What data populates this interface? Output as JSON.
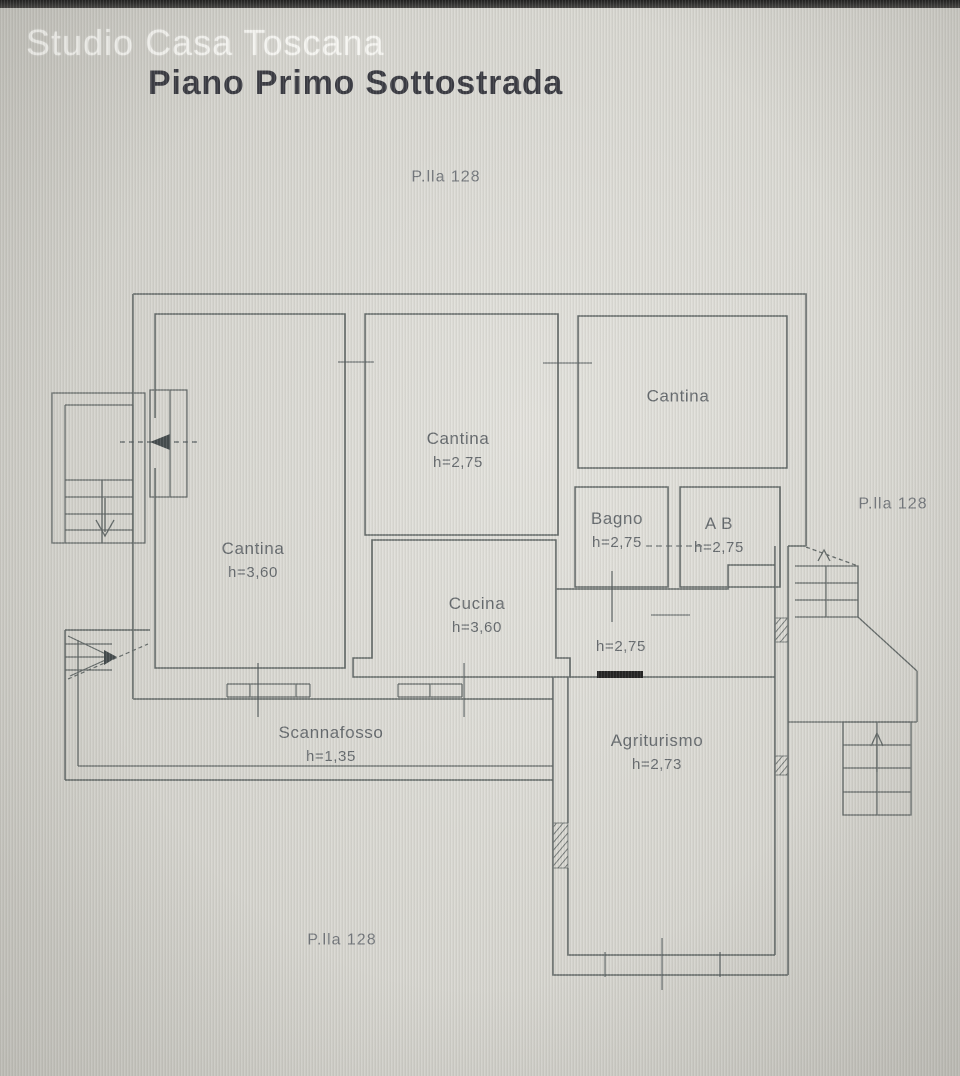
{
  "watermark": "Studio Casa Toscana",
  "title": "Piano Primo Sottostrada",
  "parcels": {
    "top": "P.lla 128",
    "right": "P.lla 128",
    "bottom": "P.lla 128"
  },
  "rooms": {
    "cantina_left": {
      "name": "Cantina",
      "height": "h=3,60"
    },
    "cantina_middle": {
      "name": "Cantina",
      "height": "h=2,75"
    },
    "cantina_right": {
      "name": "Cantina",
      "height": ""
    },
    "bagno": {
      "name": "Bagno",
      "height": "h=2,75"
    },
    "ab": {
      "name": "A B",
      "height": "h=2,75"
    },
    "cucina": {
      "name": "Cucina",
      "height": "h=3,60"
    },
    "disimpegno": {
      "name": "",
      "height": "h=2,75"
    },
    "scannafosso": {
      "name": "Scannafosso",
      "height": "h=1,35"
    },
    "agriturismo": {
      "name": "Agriturismo",
      "height": "h=2,73"
    }
  },
  "colors": {
    "paper": "#d8d7d0",
    "wall": "#5b6261",
    "tick": "#4e5658",
    "label_text": "#5f6468",
    "title_text": "#32333b",
    "threshold": "#1a1a1a",
    "watermark": "rgba(252,252,249,0.78)"
  }
}
